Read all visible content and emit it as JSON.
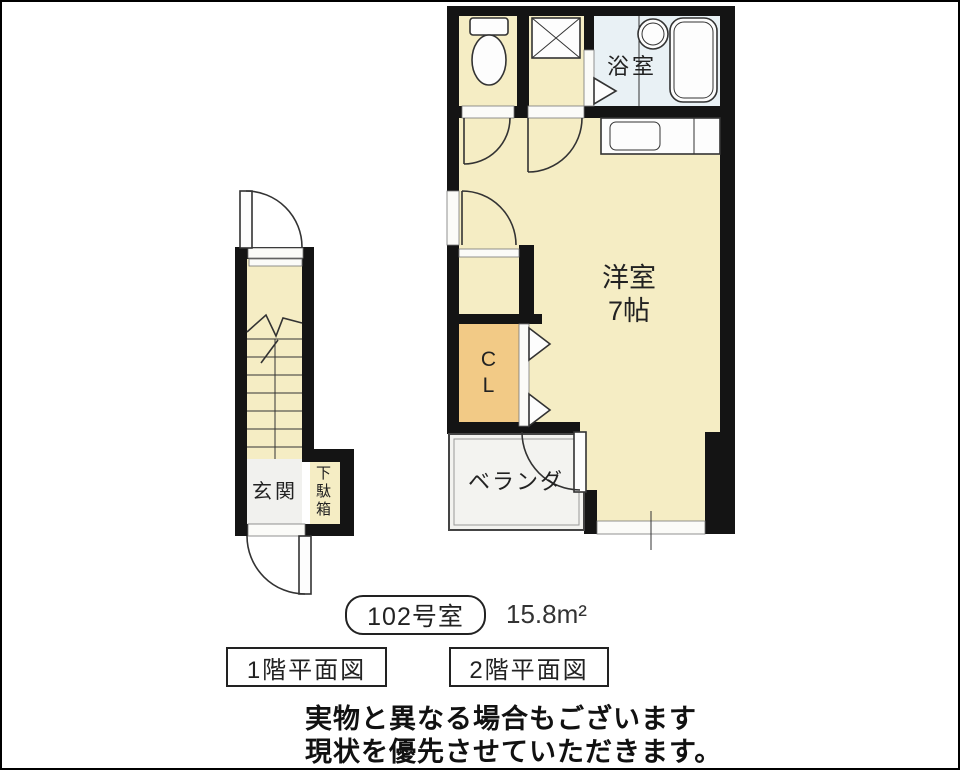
{
  "title_area": {
    "room_number": "102号室",
    "area": "15.8m²",
    "floor1_label": "1階平面図",
    "floor2_label": "2階平面図"
  },
  "rooms": {
    "bathroom": "浴室",
    "western_room_name": "洋室",
    "western_room_size": "7帖",
    "closet": "CL",
    "veranda": "ベランダ",
    "entrance": "玄関",
    "shoe_cabinet": "下駄箱"
  },
  "disclaimer": {
    "line1": "実物と異なる場合もございます",
    "line2": "現状を優先させていただきます。"
  },
  "colors": {
    "wall": "#141414",
    "room_cream": "#f5edc4",
    "closet_orange": "#f2ca86",
    "bath_blue": "#e9f1f5",
    "veranda_gray": "#f3f3f0",
    "entrance_gray": "#f1f1ee"
  }
}
